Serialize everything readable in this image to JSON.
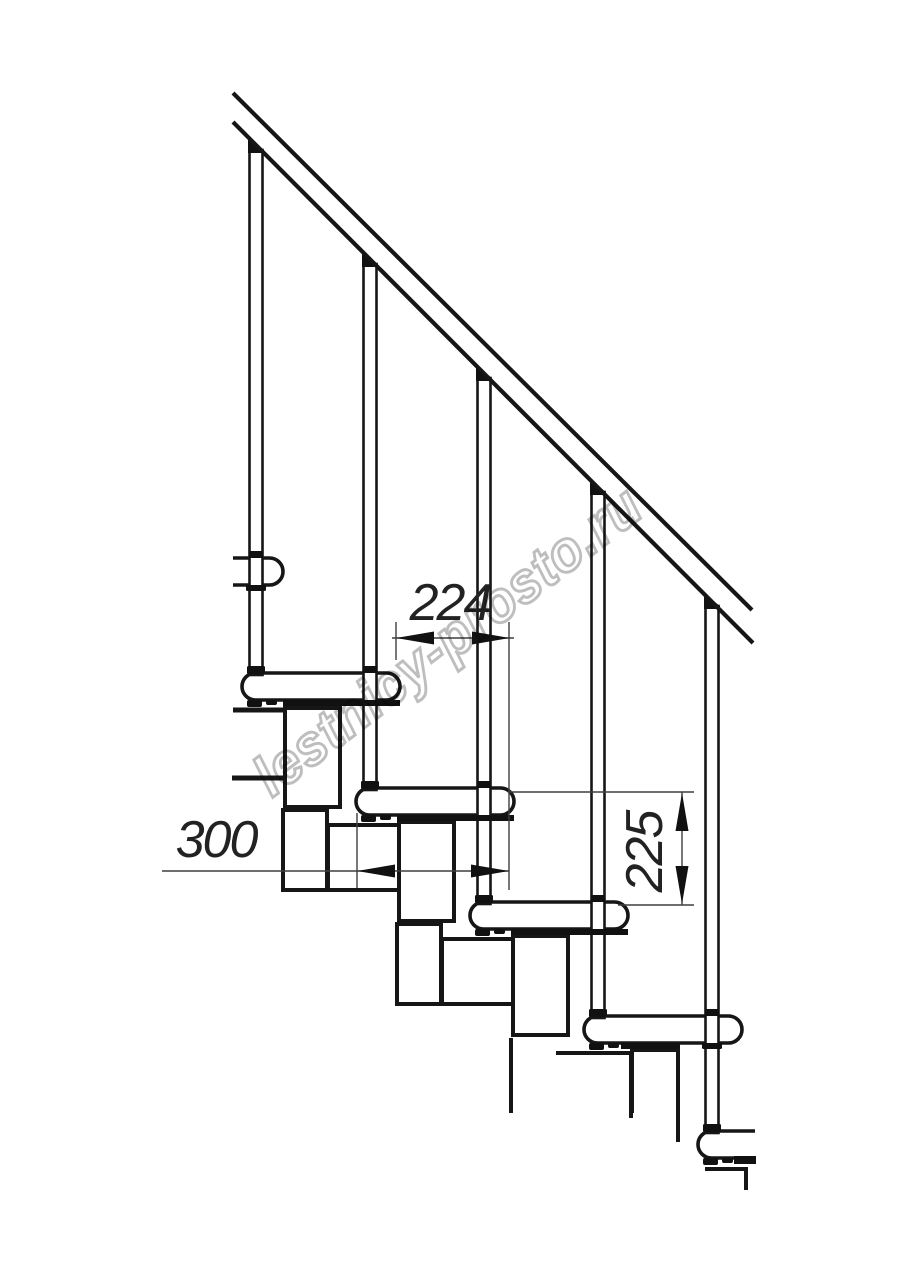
{
  "drawing": {
    "type": "staircase-technical-drawing",
    "watermark": "lestnicy-prosto.ru",
    "dimensions": {
      "step_pitch": "224",
      "tread_depth": "300",
      "step_rise": "225"
    }
  },
  "colors": {
    "line": "#161616",
    "dimension_line": "#3f3f3f",
    "watermark": "#b3b3b3",
    "background": "#ffffff"
  }
}
